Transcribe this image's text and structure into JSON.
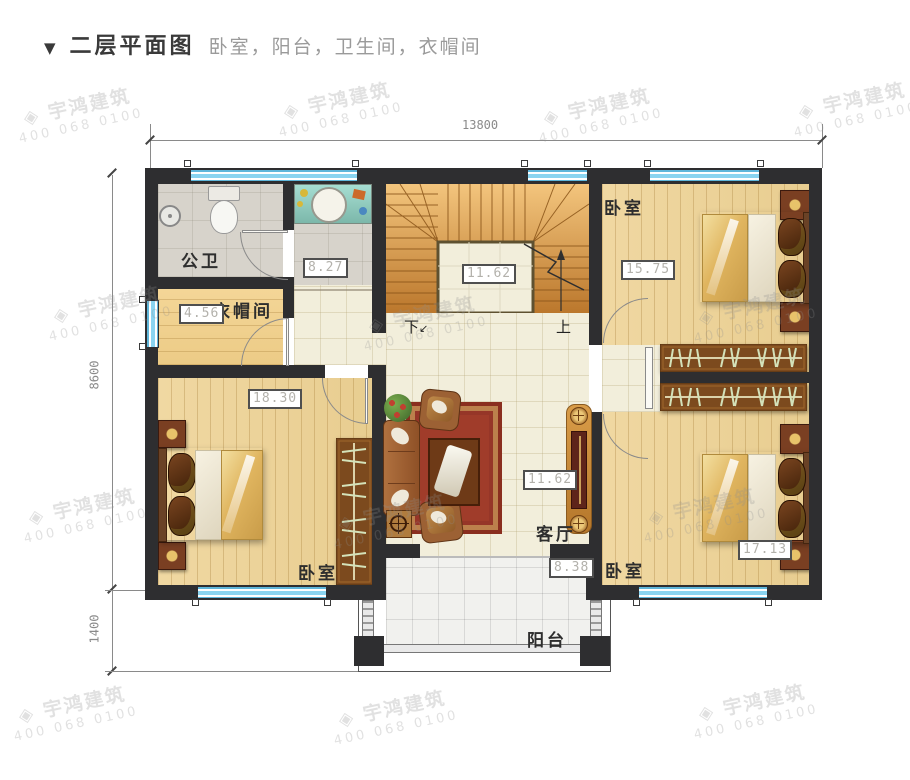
{
  "header": {
    "marker": "▼",
    "title": "二层平面图",
    "subtitle": "卧室，阳台，卫生间，衣帽间"
  },
  "dims": {
    "top": "13800",
    "left_upper": "8600",
    "left_lower": "1400"
  },
  "rooms": {
    "bathroom": {
      "name": "公卫",
      "area": "8.27"
    },
    "cloakroom": {
      "name": "衣帽间",
      "area": "4.56"
    },
    "stairwell": {
      "area": "11.62",
      "down": "下",
      "up": "上",
      "down_arrow": "↙"
    },
    "bedroom_left": {
      "name": "卧室",
      "area": "18.30"
    },
    "bedroom_top_right": {
      "name": "卧室",
      "area": "15.75"
    },
    "bedroom_bottom_right": {
      "name": "卧室",
      "area": "17.13"
    },
    "living": {
      "name": "客厅",
      "area": "11.62"
    },
    "balcony": {
      "name": "阳台",
      "area": "8.38"
    }
  },
  "watermark": {
    "logo": "◈",
    "brand": "宇鸿建筑",
    "phone": "400 068 0100"
  },
  "colors": {
    "wall": "#2e2e30",
    "window_blue": "#7fcbe8",
    "wood_floor": "#ecd29a",
    "stair_wood": "#d9903f",
    "hall_tile": "#f2eedb",
    "carpet_red": "#9c3a28",
    "wardrobe_brown": "#7c4a1e"
  }
}
